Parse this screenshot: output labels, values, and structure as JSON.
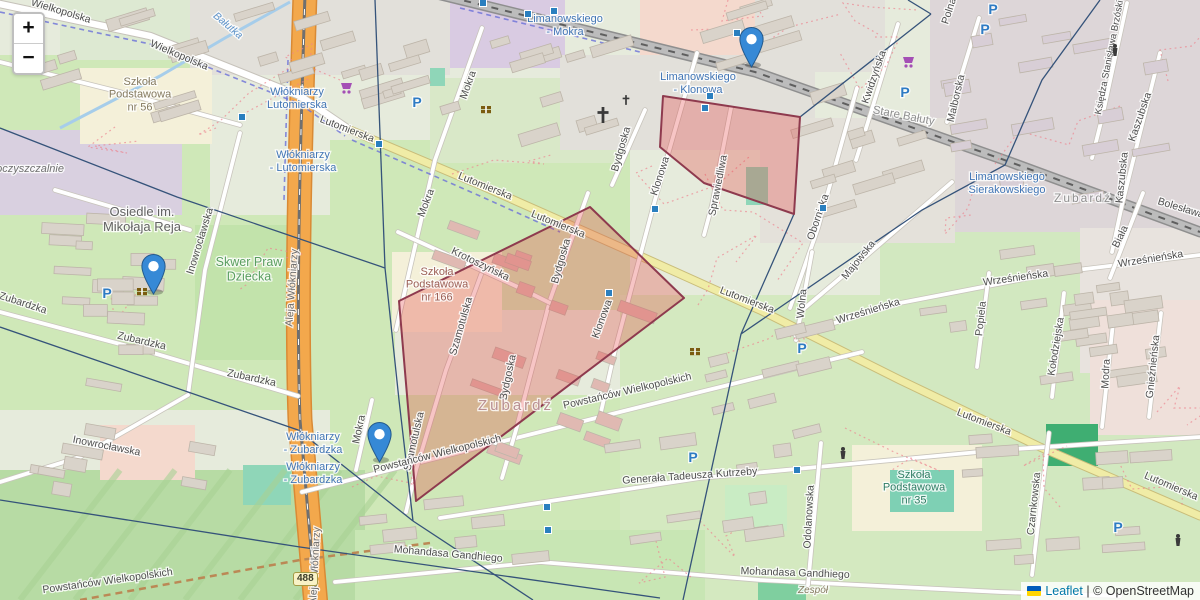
{
  "controls": {
    "zoom_in": "+",
    "zoom_out": "−"
  },
  "attribution": {
    "leaflet": "Leaflet",
    "separator": " | ",
    "copyright": "© OpenStreetMap",
    "flag_top_color": "#005BBB",
    "flag_bottom_color": "#FFD500"
  },
  "road_shield": {
    "text": "488",
    "x": 306,
    "y": 579
  },
  "markers": [
    {
      "x": 751,
      "y": 68
    },
    {
      "x": 153,
      "y": 295
    },
    {
      "x": 379,
      "y": 463
    }
  ],
  "marker_style": {
    "fill": "#3689d6",
    "stroke": "#23598c",
    "dot": "#ffffff"
  },
  "overlay": {
    "red_style": {
      "fill": "rgba(228,62,62,0.30)",
      "stroke": "#8e3a4e",
      "width": 2
    },
    "blue_style": {
      "stroke": "#35537a",
      "width": 1.3
    },
    "red_polygons": [
      {
        "points": [
          [
            399,
            301
          ],
          [
            590,
            207
          ],
          [
            684,
            298
          ],
          [
            416,
            501
          ]
        ]
      },
      {
        "points": [
          [
            663,
            96
          ],
          [
            800,
            117
          ],
          [
            794,
            214
          ],
          [
            704,
            183
          ],
          [
            660,
            147
          ]
        ]
      }
    ],
    "blue_lines": [
      [
        [
          0,
          128
        ],
        [
          177,
          197
        ],
        [
          385,
          268
        ]
      ],
      [
        [
          375,
          0
        ],
        [
          385,
          268
        ]
      ],
      [
        [
          385,
          268
        ],
        [
          399,
          400
        ],
        [
          413,
          521
        ]
      ],
      [
        [
          0,
          327
        ],
        [
          298,
          430
        ],
        [
          413,
          521
        ]
      ],
      [
        [
          413,
          521
        ],
        [
          533,
          600
        ]
      ],
      [
        [
          0,
          500
        ],
        [
          300,
          547
        ],
        [
          660,
          598
        ]
      ],
      [
        [
          931,
          14
        ],
        [
          800,
          117
        ],
        [
          794,
          214
        ],
        [
          741,
          334
        ]
      ],
      [
        [
          1100,
          0
        ],
        [
          1042,
          80
        ],
        [
          1005,
          165
        ],
        [
          922,
          210
        ],
        [
          741,
          334
        ]
      ],
      [
        [
          741,
          334
        ],
        [
          688,
          577
        ],
        [
          683,
          600
        ]
      ],
      [
        [
          931,
          14
        ],
        [
          908,
          0
        ]
      ]
    ]
  },
  "labels": {
    "street_color": "#4e4e4e",
    "street": [
      {
        "t": "Wielkopolska",
        "x": 60,
        "y": 14,
        "r": 17
      },
      {
        "t": "Wielkopolska",
        "x": 178,
        "y": 58,
        "r": 23
      },
      {
        "t": "Lutomierska",
        "x": 346,
        "y": 132,
        "r": 21
      },
      {
        "t": "Lutomierska",
        "x": 484,
        "y": 189,
        "r": 22
      },
      {
        "t": "Lutomierska",
        "x": 557,
        "y": 227,
        "r": 22
      },
      {
        "t": "Lutomierska",
        "x": 746,
        "y": 303,
        "r": 21
      },
      {
        "t": "Lutomierska",
        "x": 983,
        "y": 425,
        "r": 21
      },
      {
        "t": "Lutomierska",
        "x": 1170,
        "y": 489,
        "r": 23
      },
      {
        "t": "Zubardzka",
        "x": 22,
        "y": 306,
        "r": 18
      },
      {
        "t": "Zubardzka",
        "x": 141,
        "y": 344,
        "r": 13
      },
      {
        "t": "Zubardzka",
        "x": 251,
        "y": 381,
        "r": 12
      },
      {
        "t": "Inowrocławska",
        "x": 203,
        "y": 242,
        "r": -73
      },
      {
        "t": "Inowrocławska",
        "x": 106,
        "y": 449,
        "r": 11
      },
      {
        "t": "Mokra",
        "x": 471,
        "y": 86,
        "r": -70
      },
      {
        "t": "Mokra",
        "x": 429,
        "y": 204,
        "r": -69
      },
      {
        "t": "Mokra",
        "x": 362,
        "y": 430,
        "r": -78
      },
      {
        "t": "Klonowa",
        "x": 663,
        "y": 177,
        "r": -72
      },
      {
        "t": "Klonowa",
        "x": 605,
        "y": 320,
        "r": -70
      },
      {
        "t": "Bydgoska",
        "x": 564,
        "y": 262,
        "r": -74
      },
      {
        "t": "Bydgoska",
        "x": 511,
        "y": 378,
        "r": -78
      },
      {
        "t": "Bydgoska",
        "x": 624,
        "y": 150,
        "r": -74
      },
      {
        "t": "Szamotulska",
        "x": 464,
        "y": 327,
        "r": -74
      },
      {
        "t": "Szamotulska",
        "x": 417,
        "y": 442,
        "r": -77
      },
      {
        "t": "Krotoszyńska",
        "x": 479,
        "y": 267,
        "r": 26
      },
      {
        "t": "Sprawiedliwa",
        "x": 721,
        "y": 186,
        "r": -79
      },
      {
        "t": "Kwidzyńska",
        "x": 877,
        "y": 78,
        "r": -71
      },
      {
        "t": "Malborska",
        "x": 959,
        "y": 99,
        "r": -77
      },
      {
        "t": "Polna",
        "x": 952,
        "y": 12,
        "r": -72
      },
      {
        "t": "Księdza Stanisława Brzóski",
        "x": 1112,
        "y": 58,
        "r": -79,
        "s": 9.5
      },
      {
        "t": "Kaszubska",
        "x": 1143,
        "y": 118,
        "r": -71
      },
      {
        "t": "Kaszubska",
        "x": 1125,
        "y": 178,
        "r": -84
      },
      {
        "t": "Stare Bałuty",
        "x": 903,
        "y": 119,
        "r": 11,
        "c": "#8f8f8f",
        "s": 11.5
      },
      {
        "t": "Bolesława Limanowskiego",
        "x": 1216,
        "y": 222,
        "r": 17
      },
      {
        "t": "Obornicka",
        "x": 821,
        "y": 218,
        "r": -71
      },
      {
        "t": "Wolna",
        "x": 805,
        "y": 304,
        "r": -84
      },
      {
        "t": "Majowska",
        "x": 861,
        "y": 262,
        "r": -51
      },
      {
        "t": "Wrześnieńska",
        "x": 869,
        "y": 314,
        "r": -17
      },
      {
        "t": "Wrześnieńska",
        "x": 1016,
        "y": 281,
        "r": -8
      },
      {
        "t": "Wrześnieńska",
        "x": 1151,
        "y": 262,
        "r": -9
      },
      {
        "t": "Biała",
        "x": 1123,
        "y": 238,
        "r": -64
      },
      {
        "t": "Popiela",
        "x": 984,
        "y": 319,
        "r": -84
      },
      {
        "t": "Kołodziejska",
        "x": 1059,
        "y": 347,
        "r": -81
      },
      {
        "t": "Modra",
        "x": 1109,
        "y": 374,
        "r": -87
      },
      {
        "t": "Gnieźnieńska",
        "x": 1156,
        "y": 367,
        "r": -84
      },
      {
        "t": "Powstańców Wielkopolskich",
        "x": 438,
        "y": 457,
        "r": -14
      },
      {
        "t": "Powstańców Wielkopolskich",
        "x": 628,
        "y": 394,
        "r": -13
      },
      {
        "t": "Powstańców Wielkopolskich",
        "x": 108,
        "y": 584,
        "r": -8
      },
      {
        "t": "Generała Tadeusza Kutrzeby",
        "x": 690,
        "y": 479,
        "r": -4
      },
      {
        "t": "Mohandasa Gandhiego",
        "x": 448,
        "y": 557,
        "r": 5
      },
      {
        "t": "Mohandasa Gandhiego",
        "x": 795,
        "y": 576,
        "r": 2
      },
      {
        "t": "Odolanowska",
        "x": 812,
        "y": 517,
        "r": -87
      },
      {
        "t": "Czarnkowska",
        "x": 1037,
        "y": 504,
        "r": -84
      },
      {
        "t": "Aleja Włókniarzy",
        "x": 295,
        "y": 288,
        "r": -86,
        "c": "#6b6b6b"
      },
      {
        "t": "Aleja Włókniarzy",
        "x": 318,
        "y": 566,
        "r": -87,
        "c": "#6b6b6b"
      }
    ],
    "transit_color": "#4276b5",
    "transit": [
      {
        "lines": [
          "Limanowskiego",
          "- Mokra"
        ],
        "x": 565,
        "y": 22
      },
      {
        "lines": [
          "Limanowskiego",
          "- Klonowa"
        ],
        "x": 698,
        "y": 80
      },
      {
        "lines": [
          "Limanowskiego",
          "Sierakowskiego"
        ],
        "x": 1007,
        "y": 180
      },
      {
        "lines": [
          "Włókniarzy",
          "Lutomierska"
        ],
        "x": 297,
        "y": 95
      },
      {
        "lines": [
          "Włókniarzy",
          "- Lutomierska"
        ],
        "x": 303,
        "y": 158
      },
      {
        "lines": [
          "Włókniarzy",
          "- Zubardzka"
        ],
        "x": 313,
        "y": 440
      },
      {
        "lines": [
          "Włókniarzy",
          "- Zubardzka"
        ],
        "x": 313,
        "y": 470
      }
    ],
    "place": [
      {
        "lines": [
          "Osiedle im.",
          "Mikołaja Reja"
        ],
        "x": 142,
        "y": 216,
        "s": 13,
        "c": "#636363"
      },
      {
        "lines": [
          "Skwer Praw",
          "Dziecka"
        ],
        "x": 249,
        "y": 266,
        "s": 12.5,
        "c": "#5a9e60"
      },
      {
        "lines": [
          "Szkoła",
          "Podstawowa",
          "nr 56"
        ],
        "x": 140,
        "y": 85,
        "s": 11,
        "c": "#857a5f"
      },
      {
        "lines": [
          "Szkoła",
          "Podstawowa",
          "nr 166"
        ],
        "x": 437,
        "y": 275,
        "s": 11,
        "c": "#9c5f55"
      },
      {
        "lines": [
          "Szkoła",
          "Podstawowa",
          "nr 35"
        ],
        "x": 914,
        "y": 478,
        "s": 11,
        "c": "#2f7d64"
      },
      {
        "lines": [
          "oczyszczalnie"
        ],
        "x": 30,
        "y": 172,
        "s": 11,
        "c": "#6f6f6f",
        "i": true
      },
      {
        "lines": [
          "Zespół"
        ],
        "x": 813,
        "y": 593,
        "s": 10,
        "c": "#857a5f",
        "i": true
      },
      {
        "lines": [
          "Zubardź"
        ],
        "x": 516,
        "y": 410,
        "s": 15,
        "c": "#b98f92",
        "ls": 3
      },
      {
        "lines": [
          "Zubardź"
        ],
        "x": 1083,
        "y": 202,
        "s": 12,
        "c": "#8f8f8f",
        "ls": 2
      }
    ],
    "water": [
      {
        "t": "Bałutka",
        "x": 226,
        "y": 28,
        "r": 40,
        "c": "#5f93c8"
      }
    ]
  },
  "icons": {
    "parking_letter": "P",
    "parking_color": "#2e7bc4",
    "parking": [
      [
        107,
        298
      ],
      [
        417,
        107
      ],
      [
        905,
        97
      ],
      [
        993,
        14
      ],
      [
        985,
        34
      ],
      [
        802,
        353
      ],
      [
        693,
        462
      ],
      [
        1118,
        532
      ]
    ],
    "cart_color": "#a44fb5",
    "cart": [
      [
        347,
        88
      ],
      [
        909,
        62
      ]
    ],
    "book_color": "#7a5c10",
    "book": [
      [
        142,
        292
      ],
      [
        695,
        352
      ],
      [
        486,
        110
      ]
    ],
    "cross_color": "#3a3a3a",
    "cross": [
      [
        603,
        115
      ],
      [
        626,
        100
      ]
    ],
    "monument_color": "#3a3a3a",
    "monument": [
      [
        1115,
        50
      ],
      [
        1178,
        540
      ],
      [
        843,
        453
      ]
    ],
    "stop_square_color": "#2a7fbf",
    "stop_squares": [
      [
        483,
        3
      ],
      [
        528,
        14
      ],
      [
        554,
        11
      ],
      [
        737,
        33
      ],
      [
        710,
        96
      ],
      [
        705,
        108
      ],
      [
        379,
        144
      ],
      [
        655,
        209
      ],
      [
        823,
        208
      ],
      [
        609,
        293
      ],
      [
        797,
        470
      ],
      [
        242,
        117
      ],
      [
        547,
        507
      ],
      [
        548,
        530
      ]
    ]
  }
}
